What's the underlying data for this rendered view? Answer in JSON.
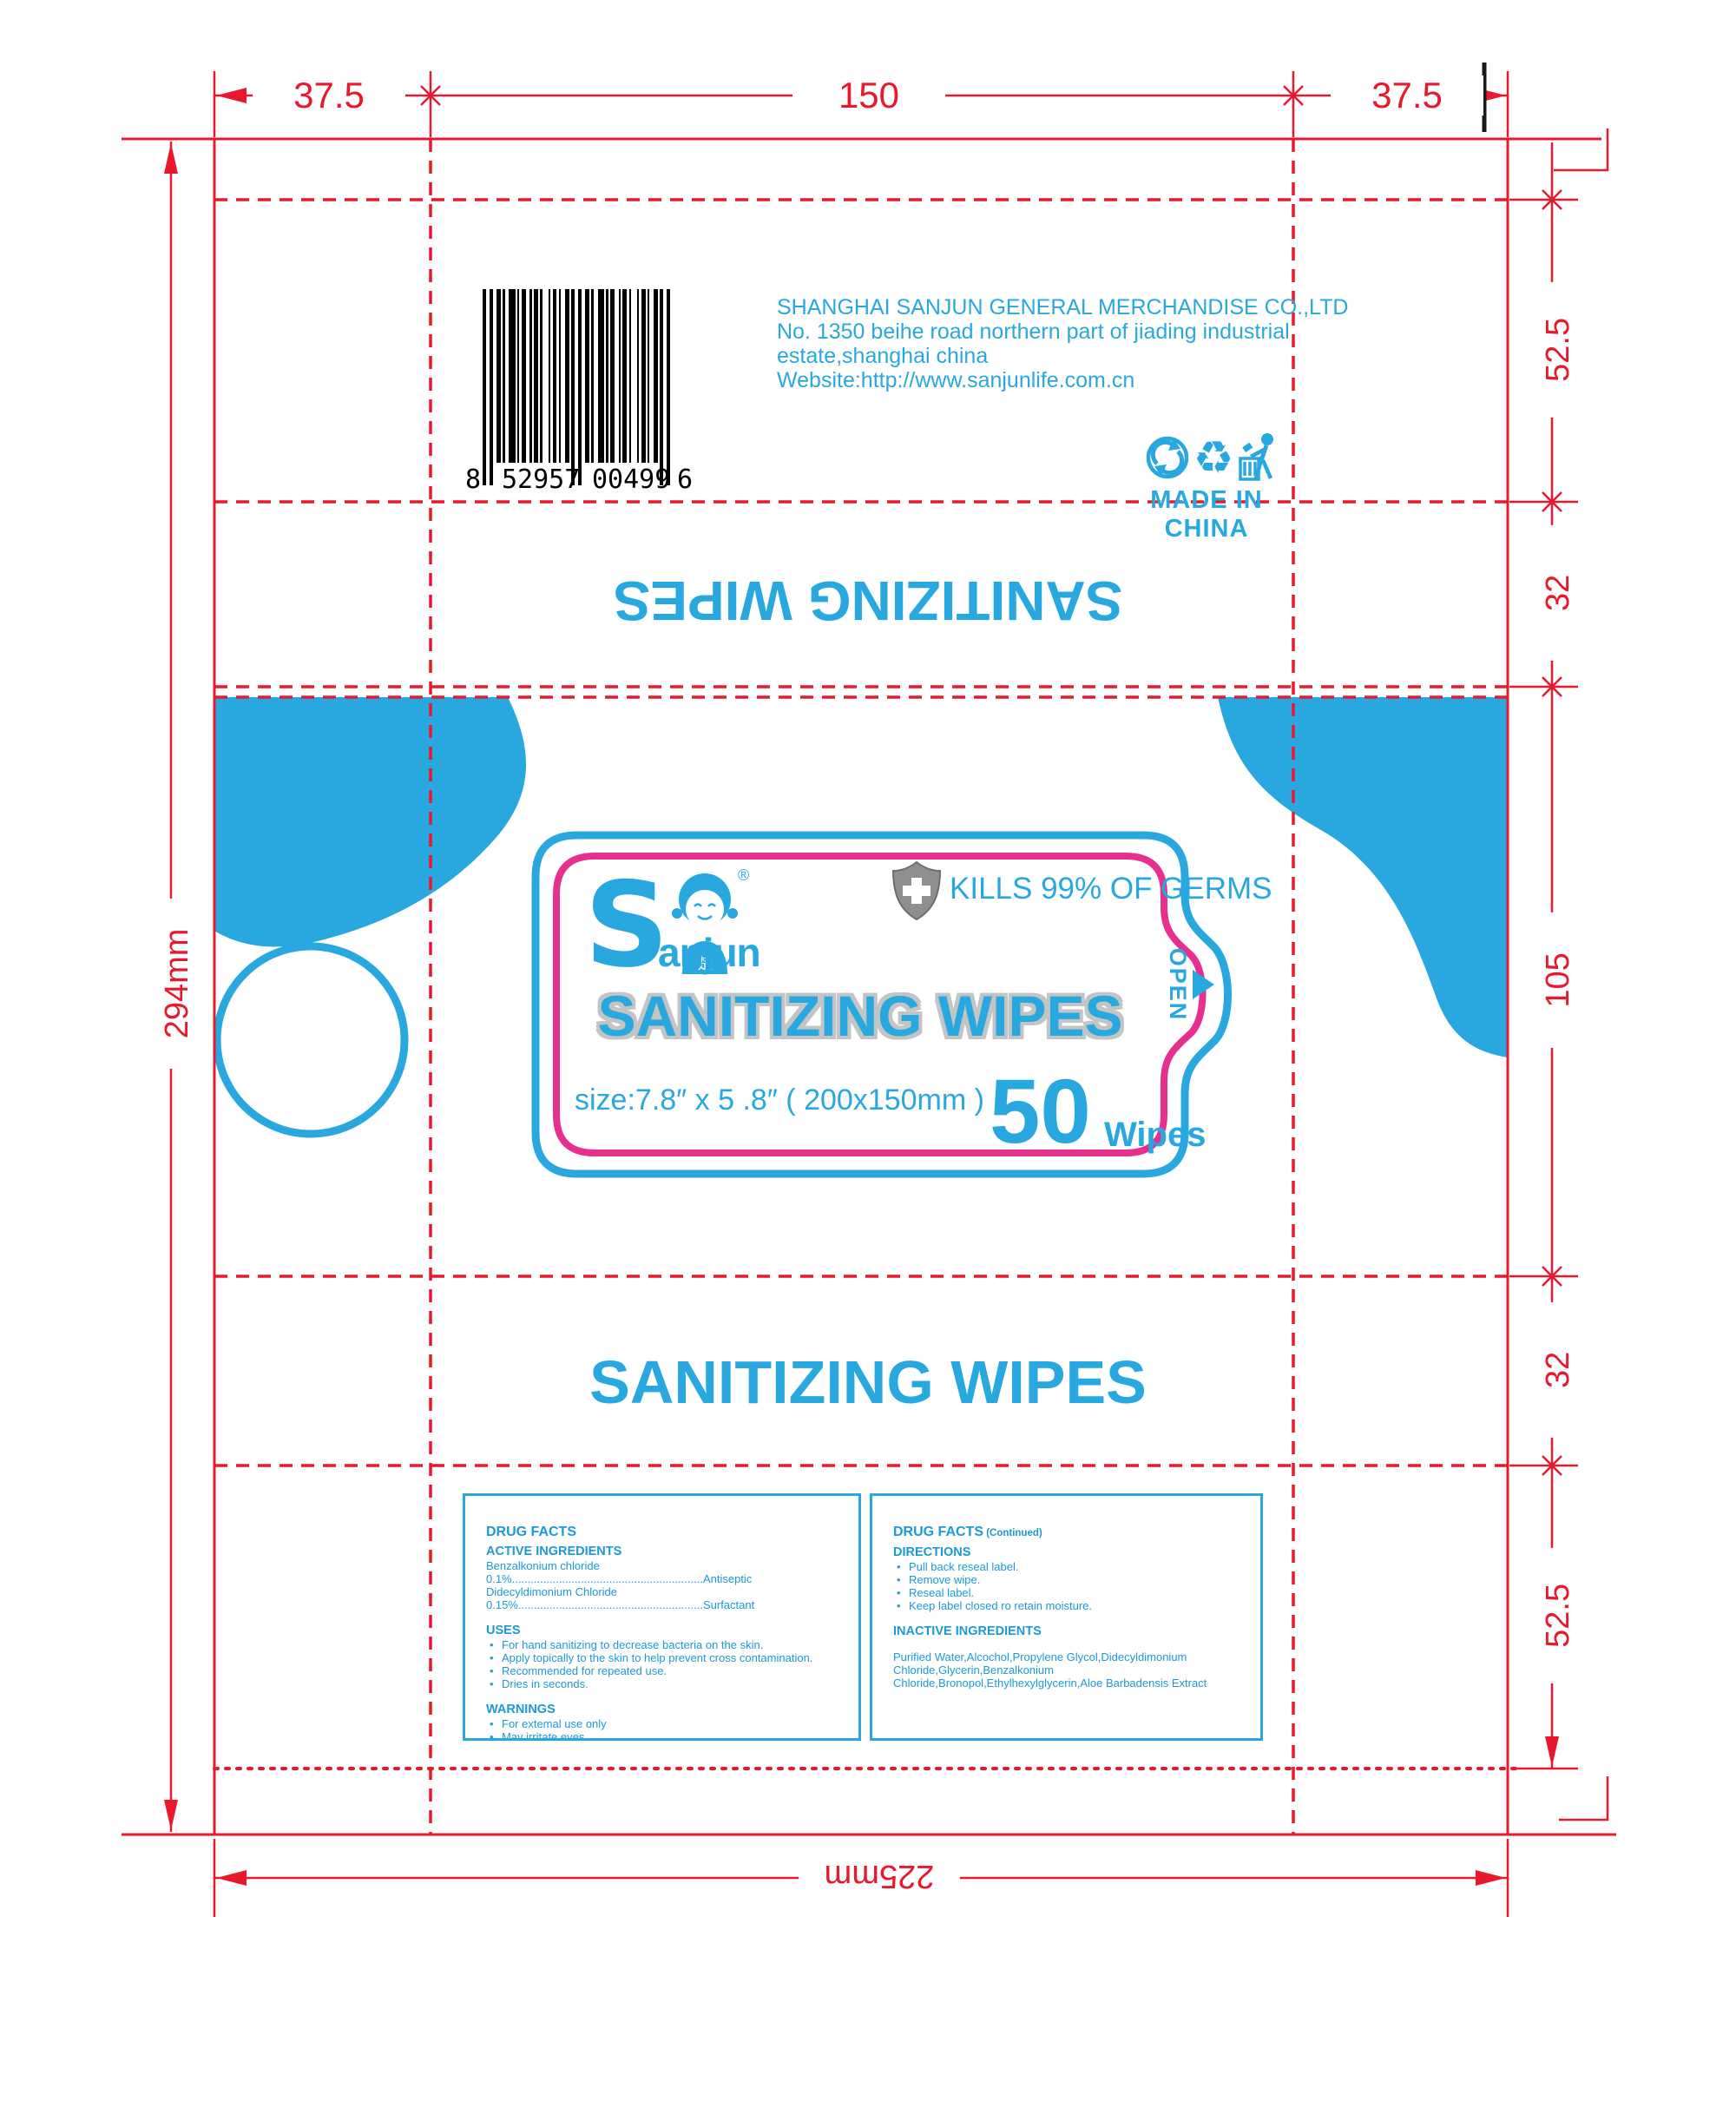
{
  "colors": {
    "blue": "#29a8df",
    "pink": "#e6308f",
    "dieline_red": "#e8192d",
    "drug_text": "#1c9ad6",
    "shield_gray": "#8f8f8f",
    "title_outline_gray": "#c4c4c4"
  },
  "dimensions": {
    "top": [
      "37.5",
      "150",
      "37.5"
    ],
    "left": "294mm",
    "right": [
      "52.5",
      "32",
      "105",
      "32",
      "52.5"
    ],
    "bottom": "225mm"
  },
  "back_panel": {
    "barcode_digits": [
      "8",
      "52957",
      "00499",
      "6"
    ],
    "company_lines": [
      "SHANGHAI SANJUN GENERAL MERCHANDISE CO.,LTD",
      "No. 1350 beihe road northern part of jiading industrial",
      "estate,shanghai china",
      "Website:http://www.sanjunlife.com.cn"
    ],
    "made_in": "MADE IN CHINA",
    "icons": [
      "green-dot-icon",
      "recycle-icon",
      "tidyman-icon"
    ]
  },
  "top_flap": {
    "title": "SANITIZING WIPES"
  },
  "front_label": {
    "brand_s": "S",
    "brand_rest": "anjun",
    "reg": "®",
    "mascot_char": "楚",
    "claim": "KILLS 99% OF GERMS",
    "title": "SANITIZING WIPES",
    "size_text": "size:7.8″ x 5 .8″  ( 200x150mm )",
    "count": "50",
    "count_unit": "Wipes",
    "open": "OPEN"
  },
  "bottom_panel": {
    "title": "SANITIZING WIPES"
  },
  "drug_facts_left": {
    "lines": [
      {
        "style": "h1",
        "text": "DRUG FACTS"
      },
      {
        "style": "h2",
        "text": "ACTIVE INGREDIENTS"
      },
      {
        "style": "p",
        "text": "Benzalkonium chloride"
      },
      {
        "style": "p",
        "text": "0.1%.............................................................Antiseptic"
      },
      {
        "style": "p",
        "text": "Didecyldimonium Chloride"
      },
      {
        "style": "p",
        "text": "0.15%...........................................................Surfactant"
      },
      {
        "style": "h2",
        "gap": true,
        "text": "USES"
      },
      {
        "style": "li",
        "text": "For hand sanitizing to decrease bacteria on the skin."
      },
      {
        "style": "li",
        "text": "Apply topically to the skin to help prevent cross contamination."
      },
      {
        "style": "li",
        "text": "Recommended for repeated use."
      },
      {
        "style": "li",
        "text": "Dries in seconds."
      },
      {
        "style": "h2",
        "gap": true,
        "text": "WARNINGS"
      },
      {
        "style": "li",
        "text": "For extemal use only"
      },
      {
        "style": "li",
        "text": "May irritate eyes"
      },
      {
        "style": "li",
        "text": "Keep out of reach of children unless under aduit supervision"
      }
    ]
  },
  "drug_facts_right": {
    "lines": [
      {
        "style": "h1",
        "text": "DRUG FACTS",
        "suffix": "(Continued)"
      },
      {
        "style": "h2",
        "text": "DIRECTIONS"
      },
      {
        "style": "li",
        "text": "Pull back reseal label."
      },
      {
        "style": "li",
        "text": "Remove wipe."
      },
      {
        "style": "li",
        "text": "Reseal label."
      },
      {
        "style": "li",
        "text": "Keep label closed ro retain moisture."
      },
      {
        "style": "h2",
        "gap": true,
        "text": "INACTIVE INGREDIENTS"
      },
      {
        "style": "p",
        "gap": true,
        "text": "Purified Water,Alcochol,Propylene Glycol,Didecyldimonium Chloride,Glycerin,Benzalkonium Chloride,Bronopol,Ethylhexylglycerin,Aloe Barbadensis Extract"
      }
    ]
  }
}
